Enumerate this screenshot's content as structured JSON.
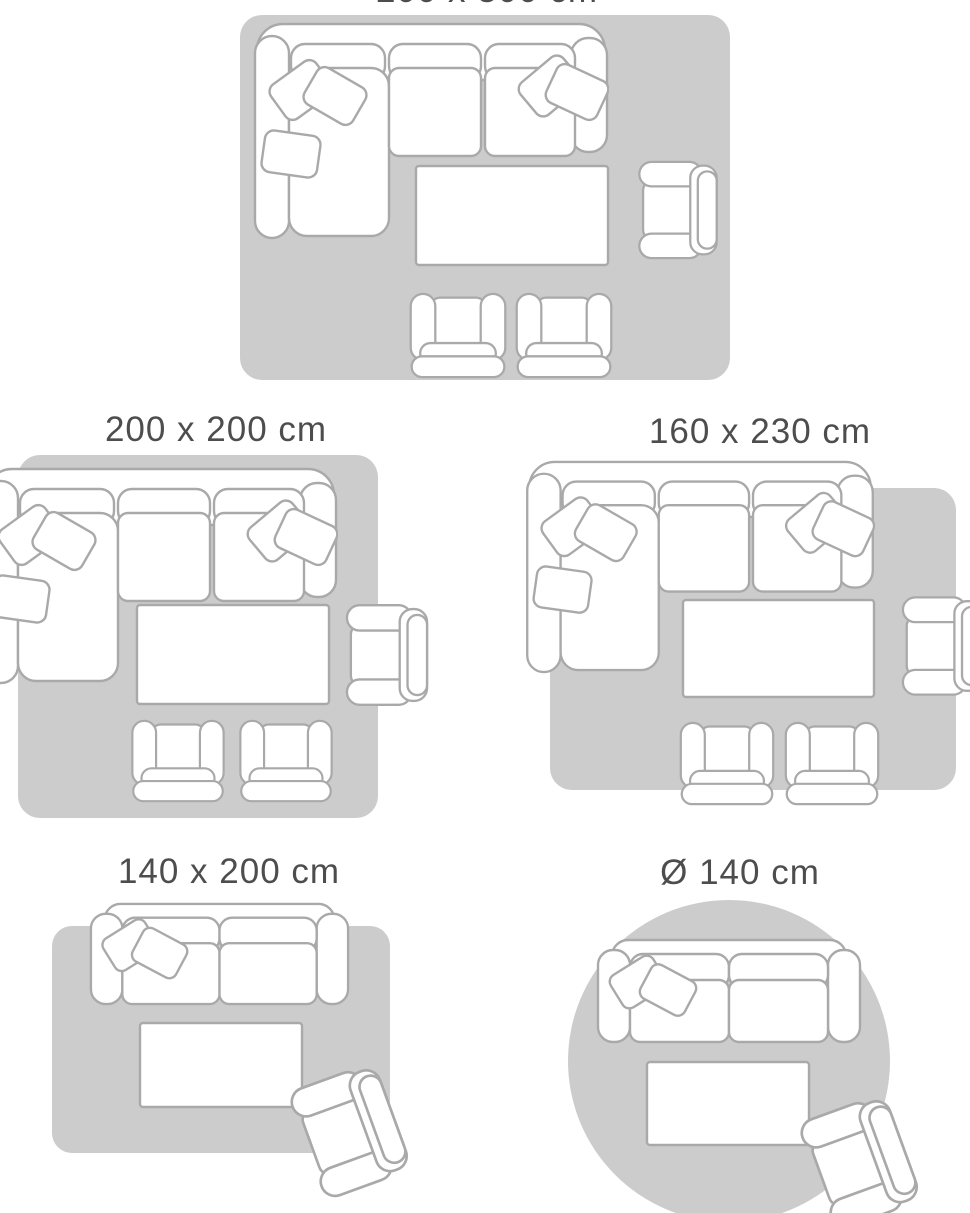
{
  "page": {
    "title": "Rug size guide",
    "background": "#ffffff",
    "colors": {
      "rug": "#cccccc",
      "furniture_fill": "#ffffff",
      "furniture_stroke": "#a9a9a9",
      "label_text": "#4d4d4d"
    }
  },
  "diagrams": [
    {
      "id": "rug-200x300",
      "label": "200 x 300 cm",
      "rug_shape": "rectangle",
      "furniture": [
        "corner-sofa",
        "coffee-table",
        "side-armchair",
        "armchair",
        "armchair"
      ]
    },
    {
      "id": "rug-200x200",
      "label": "200 x 200 cm",
      "rug_shape": "square",
      "furniture": [
        "corner-sofa",
        "coffee-table",
        "side-armchair",
        "armchair",
        "armchair"
      ]
    },
    {
      "id": "rug-160x230",
      "label": "160 x 230 cm",
      "rug_shape": "rectangle",
      "furniture": [
        "corner-sofa",
        "coffee-table",
        "side-armchair",
        "armchair",
        "armchair"
      ]
    },
    {
      "id": "rug-140x200",
      "label": "140 x 200 cm",
      "rug_shape": "rectangle",
      "furniture": [
        "two-seater-sofa",
        "coffee-table",
        "angled-armchair"
      ]
    },
    {
      "id": "rug-circle-140",
      "label": "Ø 140 cm",
      "rug_shape": "circle",
      "furniture": [
        "two-seater-sofa",
        "coffee-table",
        "angled-armchair"
      ]
    }
  ]
}
